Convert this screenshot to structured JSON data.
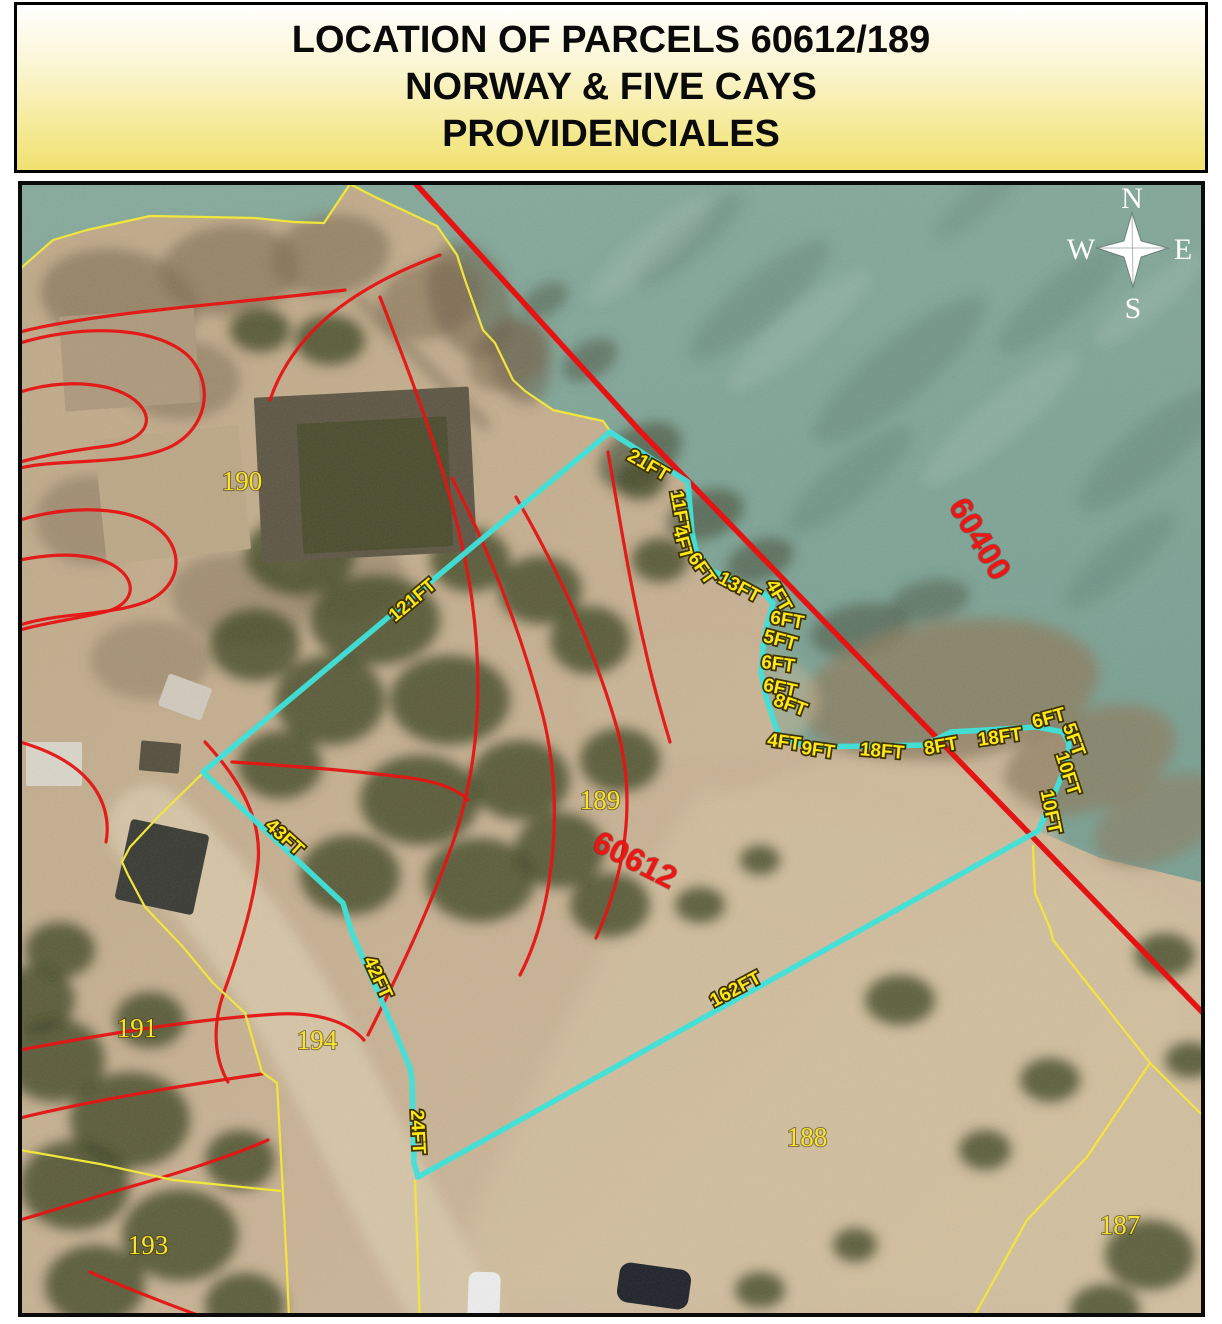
{
  "title": {
    "line1": "LOCATION OF PARCELS 60612/189",
    "line2": "NORWAY & FIVE CAYS",
    "line3": "PROVIDENCIALES"
  },
  "compass": {
    "north": "N",
    "east": "E",
    "south": "S",
    "west": "W",
    "cx": 1132,
    "cy": 250,
    "star": "1132,213 1141,241 1168,248 1141,257 1133,287 1124,257 1097,248 1124,241"
  },
  "colors": {
    "parcel_outline_cyan": "#3fe2da",
    "boundary_yellow": "#f0e63c",
    "contour_red": "#e51414",
    "label_yellow": "#ffe818",
    "label_red": "#ee1515",
    "sea_top": "#87aa9c",
    "sea_bottom": "#7aa193",
    "land": "#c1ab8b",
    "title_bg": "#f0e170"
  },
  "map": {
    "sea_path": "M 18 183 L 18 270 L 53 240 L 87 230 L 150 216 L 207 217 L 255 218 L 294 222 L 324 223 L 350 184 L 373 196 L 437 226 L 457 255 L 465 280 L 483 330 L 495 343 L 513 380 L 525 391 L 553 410 L 580 416 L 603 421 L 610 431 L 688 482 L 692 532 L 696 551 L 712 571 L 763 593 L 773 603 L 766 628 L 763 648 L 761 673 L 766 697 L 774 722 L 779 736 L 808 747 L 925 745 L 951 732 L 1037 727 L 1063 732 L 1069 743 L 1067 763 L 1053 797 L 1038 831 L 1100 858 L 1160 872 L 1205 883 L 1205 183 Z",
    "beach_path": "M 700 790 C 850 800 1000 832 1100 870 C 1160 895 1200 920 1205 940 L 1205 1313 L 430 1313 C 520 1120 600 940 700 790 Z",
    "roads": [
      {
        "d": "M 150 828 C 235 905 295 1005 345 1105 C 385 1185 425 1262 462 1324",
        "stroke": "#d7c7a9",
        "w": 85,
        "op": 0.9
      },
      {
        "d": "M 360 300 L 485 425",
        "stroke": "#93836a",
        "w": 10,
        "op": 0.9
      }
    ],
    "water_blobs": [
      [
        760,
        300,
        90,
        25,
        -40,
        "#5e7a6e",
        0.35
      ],
      [
        900,
        370,
        110,
        30,
        -40,
        "#5e7a6e",
        0.35
      ],
      [
        1060,
        300,
        80,
        22,
        -40,
        "#5e7a6e",
        0.3
      ],
      [
        1150,
        450,
        90,
        26,
        -40,
        "#5e7a6e",
        0.35
      ],
      [
        690,
        240,
        70,
        18,
        -40,
        "#5e7a6e",
        0.3
      ],
      [
        980,
        200,
        60,
        16,
        -40,
        "#5e7a6e",
        0.25
      ],
      [
        1120,
        560,
        70,
        20,
        -40,
        "#5e7a6e",
        0.3
      ],
      [
        850,
        480,
        80,
        22,
        -40,
        "#5e7a6e",
        0.3
      ],
      [
        650,
        250,
        80,
        18,
        -40,
        "#a8c4b6",
        0.3
      ],
      [
        800,
        330,
        90,
        20,
        -40,
        "#a8c4b6",
        0.3
      ],
      [
        1000,
        420,
        100,
        22,
        -40,
        "#a8c4b6",
        0.3
      ],
      [
        1150,
        300,
        70,
        16,
        -40,
        "#a8c4b6",
        0.3
      ],
      [
        640,
        455,
        45,
        28,
        -30,
        "#4f5844",
        0.7
      ],
      [
        705,
        515,
        40,
        24,
        -20,
        "#4f5844",
        0.7
      ],
      [
        760,
        560,
        35,
        20,
        -20,
        "#4f5844",
        0.65
      ],
      [
        590,
        360,
        30,
        18,
        -30,
        "#4f5844",
        0.55
      ],
      [
        545,
        300,
        25,
        15,
        -30,
        "#4f5844",
        0.5
      ],
      [
        860,
        630,
        50,
        26,
        -10,
        "#4f5844",
        0.6
      ],
      [
        930,
        600,
        40,
        20,
        -10,
        "#4f5844",
        0.5
      ],
      [
        950,
        690,
        150,
        70,
        -8,
        "#8d7c5f",
        0.75
      ],
      [
        1090,
        760,
        90,
        50,
        -20,
        "#8d7c5f",
        0.7
      ],
      [
        1160,
        820,
        70,
        40,
        -25,
        "#8d7c5f",
        0.6
      ]
    ],
    "terrain_blobs": [
      [
        120,
        300,
        80,
        50,
        10,
        "#7d6c51",
        0.6
      ],
      [
        230,
        270,
        70,
        45,
        -5,
        "#7d6c51",
        0.6
      ],
      [
        330,
        255,
        60,
        40,
        -10,
        "#7d6c51",
        0.6
      ],
      [
        430,
        300,
        55,
        38,
        -20,
        "#7d6c51",
        0.55
      ],
      [
        510,
        355,
        45,
        32,
        -30,
        "#7d6c51",
        0.55
      ],
      [
        180,
        380,
        60,
        40,
        0,
        "#7d6c51",
        0.5
      ],
      [
        90,
        520,
        55,
        45,
        0,
        "#7d6c51",
        0.45
      ],
      [
        240,
        600,
        70,
        45,
        10,
        "#7d6c51",
        0.45
      ],
      [
        150,
        660,
        60,
        40,
        0,
        "#7d6c51",
        0.4
      ],
      [
        350,
        580,
        55,
        40,
        -10,
        "#7d6c51",
        0.4
      ],
      [
        420,
        470,
        50,
        35,
        -20,
        "#7d6c51",
        0.45
      ],
      [
        470,
        300,
        40,
        60,
        -20,
        "#6e6049",
        0.55
      ],
      [
        520,
        360,
        30,
        45,
        -15,
        "#6e6049",
        0.5
      ],
      [
        880,
        850,
        180,
        90,
        0,
        "#d0bd9d",
        0.6
      ],
      [
        700,
        700,
        120,
        60,
        0,
        "#cbb795",
        0.5
      ]
    ],
    "veg_blobs": [
      [
        300,
        555,
        55,
        40
      ],
      [
        375,
        620,
        65,
        45
      ],
      [
        330,
        700,
        55,
        45
      ],
      [
        450,
        700,
        60,
        45
      ],
      [
        420,
        800,
        60,
        45
      ],
      [
        520,
        780,
        50,
        40
      ],
      [
        560,
        850,
        45,
        38
      ],
      [
        610,
        905,
        40,
        32
      ],
      [
        480,
        880,
        55,
        42
      ],
      [
        280,
        765,
        42,
        34
      ],
      [
        255,
        645,
        45,
        36
      ],
      [
        350,
        875,
        50,
        40
      ],
      [
        590,
        640,
        40,
        34
      ],
      [
        540,
        590,
        42,
        34
      ],
      [
        470,
        560,
        40,
        32
      ],
      [
        620,
        760,
        40,
        32
      ],
      [
        660,
        560,
        28,
        22
      ],
      [
        640,
        480,
        25,
        20
      ],
      [
        330,
        340,
        35,
        25
      ],
      [
        260,
        330,
        30,
        22
      ],
      [
        55,
        1060,
        50,
        42
      ],
      [
        130,
        1120,
        60,
        48
      ],
      [
        75,
        1185,
        55,
        45
      ],
      [
        180,
        1235,
        58,
        46
      ],
      [
        95,
        1285,
        50,
        40
      ],
      [
        245,
        1305,
        40,
        32
      ],
      [
        35,
        1000,
        40,
        34
      ],
      [
        150,
        1020,
        35,
        28
      ],
      [
        240,
        1160,
        35,
        30
      ],
      [
        60,
        950,
        35,
        28
      ],
      [
        900,
        1000,
        35,
        25
      ],
      [
        1050,
        1080,
        30,
        22
      ],
      [
        985,
        1150,
        26,
        20
      ],
      [
        1150,
        1255,
        45,
        35
      ],
      [
        1105,
        1310,
        35,
        26
      ],
      [
        855,
        1245,
        22,
        17
      ],
      [
        1165,
        955,
        30,
        22
      ],
      [
        1190,
        1060,
        25,
        18
      ],
      [
        760,
        1290,
        25,
        18
      ],
      [
        700,
        905,
        25,
        18
      ],
      [
        760,
        860,
        20,
        15
      ]
    ],
    "structures": [
      {
        "n": "quarry-pit",
        "x": 258,
        "y": 392,
        "w": 215,
        "h": 165,
        "f": "#5f5745",
        "r": -3,
        "rx": 2
      },
      {
        "n": "quarry-pool",
        "x": 300,
        "y": 420,
        "w": 150,
        "h": 130,
        "f": "#4c4c2e",
        "r": -3,
        "rx": 2
      },
      {
        "n": "gravel-pad",
        "x": 100,
        "y": 432,
        "w": 145,
        "h": 125,
        "f": "#bca887",
        "r": -6,
        "rx": 2
      },
      {
        "n": "gravel-pad",
        "x": 62,
        "y": 312,
        "w": 135,
        "h": 95,
        "f": "#ae9a7c",
        "r": -4,
        "rx": 2
      },
      {
        "n": "truck",
        "x": 122,
        "y": 826,
        "w": 80,
        "h": 82,
        "f": "#3b3b36",
        "r": 12,
        "rx": 4
      },
      {
        "n": "shed",
        "x": 26,
        "y": 742,
        "w": 56,
        "h": 44,
        "f": "#d9d5c9",
        "r": 0,
        "rx": 2
      },
      {
        "n": "shed",
        "x": 140,
        "y": 742,
        "w": 40,
        "h": 30,
        "f": "#55503f",
        "r": 5,
        "rx": 2
      },
      {
        "n": "white-container",
        "x": 162,
        "y": 680,
        "w": 46,
        "h": 34,
        "f": "#cfcabc",
        "r": 20,
        "rx": 3
      },
      {
        "n": "white-car",
        "x": 468,
        "y": 1272,
        "w": 32,
        "h": 52,
        "f": "#ececec",
        "r": 2,
        "rx": 8
      },
      {
        "n": "dark-car",
        "x": 618,
        "y": 1266,
        "w": 72,
        "h": 40,
        "f": "#20242a",
        "r": 8,
        "rx": 11
      }
    ],
    "contours": [
      "M 20 343 C 90 322 165 328 192 360 C 214 388 206 428 172 446 C 132 466 62 458 20 468",
      "M 20 392 C 66 378 118 382 139 404 C 156 422 143 441 108 446 C 74 450 42 456 20 462",
      "M 20 520 C 70 505 130 505 160 530 C 185 552 180 585 150 600 C 115 616 60 612 20 625",
      "M 20 560 C 60 552 100 553 120 570 C 138 585 132 605 105 612 C 75 619 40 624 20 630",
      "M 345 290 C 280 298 200 305 140 312 C 90 318 50 324 20 332",
      "M 440 255 C 400 270 360 290 330 315 C 300 340 280 370 270 400",
      "M 380 297 C 420 400 458 500 472 600 C 484 690 478 770 452 845 C 430 908 398 975 368 1035",
      "M 452 478 C 492 556 522 636 543 716 C 556 768 558 830 548 888 C 542 922 532 952 520 975",
      "M 516 497 C 558 570 594 648 617 728 C 628 768 630 812 622 856 C 616 888 605 918 596 938",
      "M 608 452 C 620 520 630 585 645 648 C 652 680 661 712 670 742",
      "M 232 762 C 290 766 350 770 410 778 C 440 782 458 790 468 800",
      "M 205 742 C 243 783 262 822 258 863 C 254 902 240 948 224 992 C 212 1026 214 1058 228 1082",
      "M 20 1050 C 100 1035 195 1019 278 1014 C 318 1012 348 1022 364 1040",
      "M 20 1118 C 85 1102 172 1087 262 1074",
      "M 268 1140 C 222 1160 168 1176 126 1188 C 88 1199 48 1212 20 1220",
      "M 90 1272 C 130 1290 178 1308 222 1324",
      "M 20 742 C 48 750 72 762 88 780 C 104 798 110 820 106 842"
    ],
    "red_boundary_60400": "415,183 640,431 1203,1013",
    "yellow_lines": [
      "20,269 53,240 87,230 150,216 207,217 255,218 294,222 324,223 350,184 373,196 437,226 457,255 465,280 483,330 495,343 513,380 525,391 553,410 580,416 603,421 610,431",
      "203,773 160,815 130,847 122,862 128,875 145,907 183,947 213,983 245,1013 262,1072 277,1083 283,1193 287,1270 289,1317",
      "20,1150 100,1164 173,1180 281,1191",
      "415,1180 420,1324",
      "1033,845 1035,893 1050,928 1053,940 1150,1063 1205,1118",
      "1150,1063 1087,1157 1027,1220 973,1318"
    ],
    "parcel_outline": "610,432 688,482 692,532 696,551 712,571 763,593 773,603 766,628 763,648 761,673 766,697 774,722 779,736 808,747 925,745 951,732 1037,727 1063,732 1069,743 1067,763 1053,797 1038,831 418,1177 414,1163 412,1080 410,1068 393,1027 352,933 343,903 203,772",
    "measurements": [
      {
        "t": "121FT",
        "x": 413,
        "y": 601,
        "r": -40
      },
      {
        "t": "21FT",
        "x": 648,
        "y": 466,
        "r": 30
      },
      {
        "t": "11FT",
        "x": 679,
        "y": 512,
        "r": 80
      },
      {
        "t": "4FT",
        "x": 682,
        "y": 543,
        "r": 75
      },
      {
        "t": "6FT",
        "x": 701,
        "y": 569,
        "r": 55
      },
      {
        "t": "13FT",
        "x": 739,
        "y": 588,
        "r": 28
      },
      {
        "t": "4FT",
        "x": 778,
        "y": 596,
        "r": 60
      },
      {
        "t": "6FT",
        "x": 787,
        "y": 621,
        "r": 10
      },
      {
        "t": "5FT",
        "x": 780,
        "y": 641,
        "r": 15
      },
      {
        "t": "6FT",
        "x": 778,
        "y": 665,
        "r": 8
      },
      {
        "t": "6FT",
        "x": 780,
        "y": 689,
        "r": 12
      },
      {
        "t": "8FT",
        "x": 790,
        "y": 706,
        "r": 20
      },
      {
        "t": "4FT",
        "x": 784,
        "y": 743,
        "r": 8
      },
      {
        "t": "9FT",
        "x": 818,
        "y": 751,
        "r": 8
      },
      {
        "t": "18FT",
        "x": 882,
        "y": 752,
        "r": 5
      },
      {
        "t": "8FT",
        "x": 941,
        "y": 747,
        "r": -10
      },
      {
        "t": "18FT",
        "x": 1000,
        "y": 738,
        "r": -8
      },
      {
        "t": "6FT",
        "x": 1049,
        "y": 719,
        "r": -15
      },
      {
        "t": "5FT",
        "x": 1073,
        "y": 740,
        "r": 70
      },
      {
        "t": "10FT",
        "x": 1067,
        "y": 774,
        "r": 72
      },
      {
        "t": "10FT",
        "x": 1050,
        "y": 812,
        "r": 78
      },
      {
        "t": "43FT",
        "x": 284,
        "y": 838,
        "r": 42
      },
      {
        "t": "42FT",
        "x": 377,
        "y": 978,
        "r": 65
      },
      {
        "t": "24FT",
        "x": 417,
        "y": 1132,
        "r": 87
      },
      {
        "t": "162FT",
        "x": 736,
        "y": 990,
        "r": -28
      }
    ],
    "parcel_numbers": [
      {
        "t": "190",
        "x": 242,
        "y": 484,
        "r": 0
      },
      {
        "t": "189",
        "x": 600,
        "y": 803,
        "r": 0
      },
      {
        "t": "191",
        "x": 137,
        "y": 1031,
        "r": 0
      },
      {
        "t": "194",
        "x": 317,
        "y": 1043,
        "r": 0
      },
      {
        "t": "193",
        "x": 148,
        "y": 1248,
        "r": 0
      },
      {
        "t": "188",
        "x": 807,
        "y": 1140,
        "r": 0
      },
      {
        "t": "187",
        "x": 1120,
        "y": 1228,
        "r": 0
      }
    ],
    "parcel_ids_red": [
      {
        "t": "60612",
        "x": 634,
        "y": 862,
        "r": 27
      },
      {
        "t": "60400",
        "x": 978,
        "y": 540,
        "r": 59
      }
    ]
  }
}
